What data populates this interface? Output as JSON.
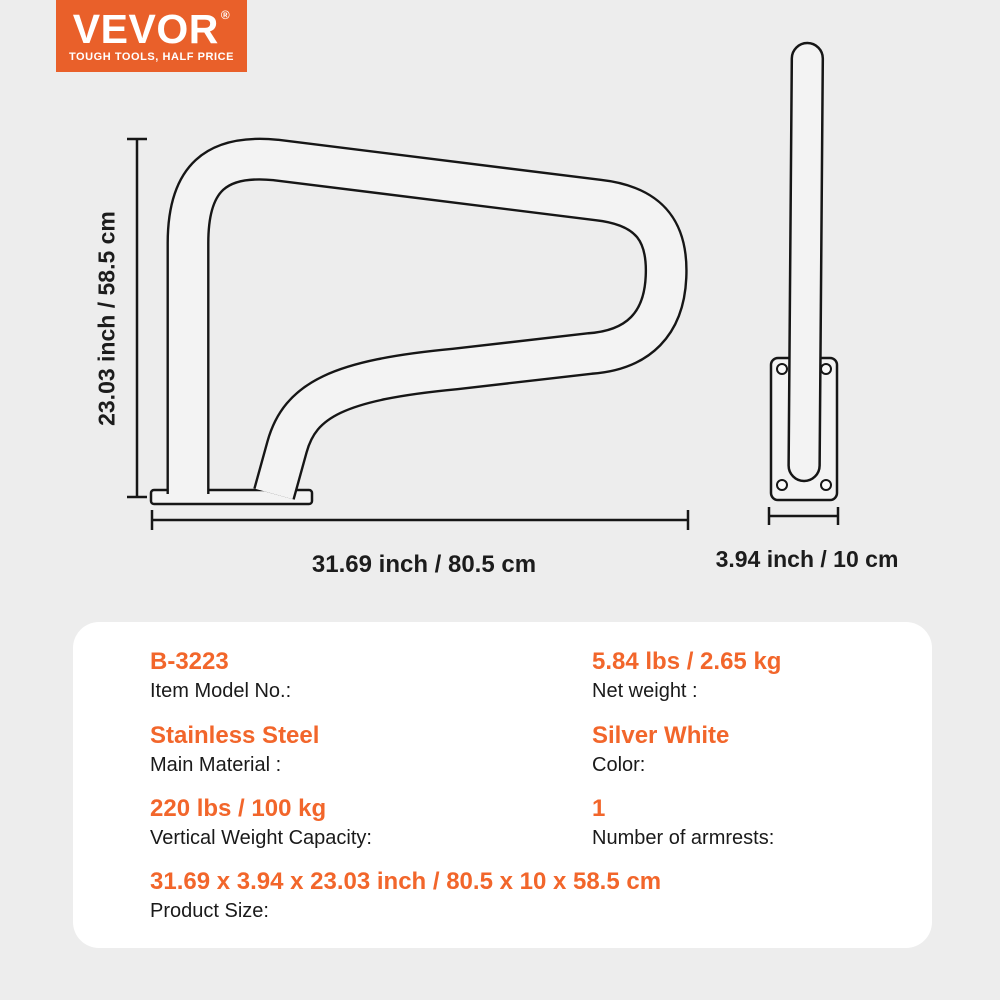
{
  "colors": {
    "background": "#EDEDED",
    "card_background": "#FFFFFF",
    "accent_orange": "#F2662B",
    "logo_background": "#E9602A",
    "line_color": "#161616",
    "tube_fill": "#F3F3F3"
  },
  "logo": {
    "brand": "VEVOR",
    "registered": "®",
    "tagline": "TOUGH TOOLS, HALF PRICE"
  },
  "diagram": {
    "height_label": "23.03 inch / 58.5 cm",
    "width_label": "31.69 inch / 80.5 cm",
    "depth_label": "3.94 inch / 10 cm"
  },
  "specs": {
    "items": [
      {
        "value": "B-3223",
        "label": "Item Model No.:"
      },
      {
        "value": "5.84 lbs / 2.65 kg",
        "label": "Net weight :"
      },
      {
        "value": "Stainless Steel",
        "label": "Main Material :"
      },
      {
        "value": "Silver White",
        "label": "Color:"
      },
      {
        "value": "220 lbs / 100 kg",
        "label": "Vertical Weight Capacity:"
      },
      {
        "value": "1",
        "label": "Number of armrests:"
      },
      {
        "value": "31.69 x 3.94 x 23.03 inch / 80.5 x 10 x 58.5 cm",
        "label": "Product Size:"
      }
    ]
  }
}
